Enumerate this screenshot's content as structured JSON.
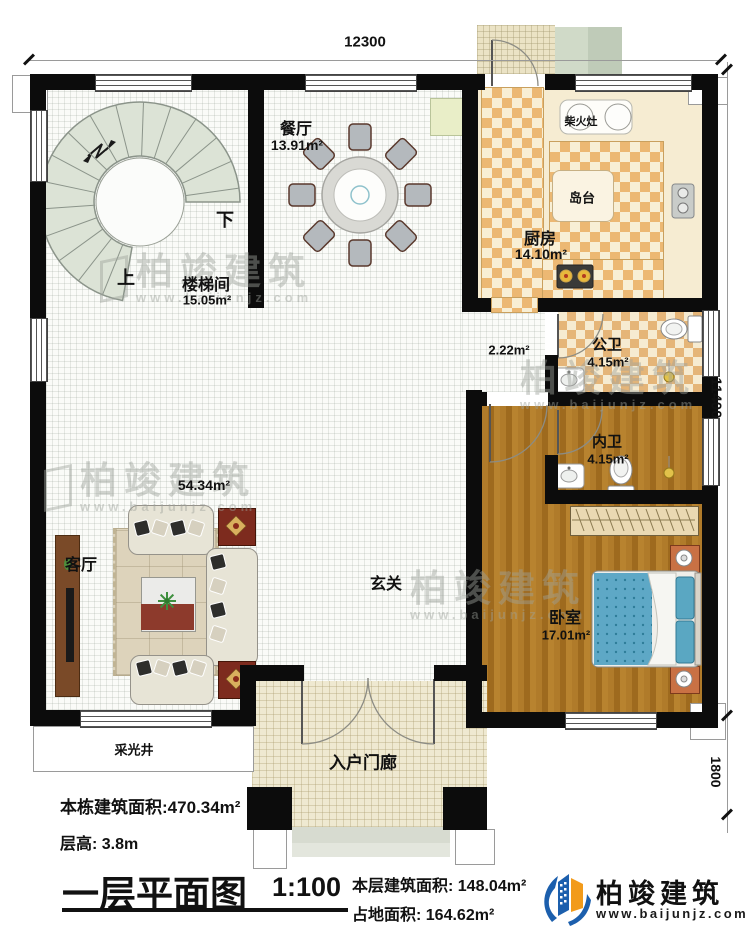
{
  "dimensions": {
    "top": "12300",
    "right_upper": "11400",
    "right_lower": "1800"
  },
  "rooms": {
    "stairwell": {
      "name": "楼梯间",
      "area": "15.05m²",
      "up": "上",
      "down": "下"
    },
    "dining": {
      "name": "餐厅",
      "area": "13.91m²"
    },
    "kitchen": {
      "name": "厨房",
      "area": "14.10m²"
    },
    "wood_stove": {
      "name": "柴火灶"
    },
    "island": {
      "name": "岛台"
    },
    "corridor": {
      "area": "2.22m²"
    },
    "public_bath": {
      "name": "公卫",
      "area": "4.15m²"
    },
    "inner_bath": {
      "name": "内卫",
      "area": "4.15m²"
    },
    "living": {
      "name": "客厅",
      "area": "54.34m²"
    },
    "foyer": {
      "name": "玄关"
    },
    "bedroom": {
      "name": "卧室",
      "area": "17.01m²"
    },
    "porch": {
      "name": "入户门廊"
    },
    "light_well": {
      "name": "采光井"
    }
  },
  "title_block": {
    "building_area": "本栋建筑面积:470.34m²",
    "floor_height": "层高: 3.8m",
    "title": "一层平面图",
    "scale": "1:100",
    "floor_area": "本层建筑面积: 148.04m²",
    "footprint": "占地面积: 164.62m²"
  },
  "brand": {
    "name": "柏竣建筑",
    "site": "www.baijunjz.com"
  },
  "watermark": {
    "name": "柏竣建筑",
    "site": "www.baijunjz.com"
  },
  "colors": {
    "accent_blue": "#1c5fad",
    "accent_orange": "#f29b1b",
    "bed_blue": "#5ea8c6"
  }
}
